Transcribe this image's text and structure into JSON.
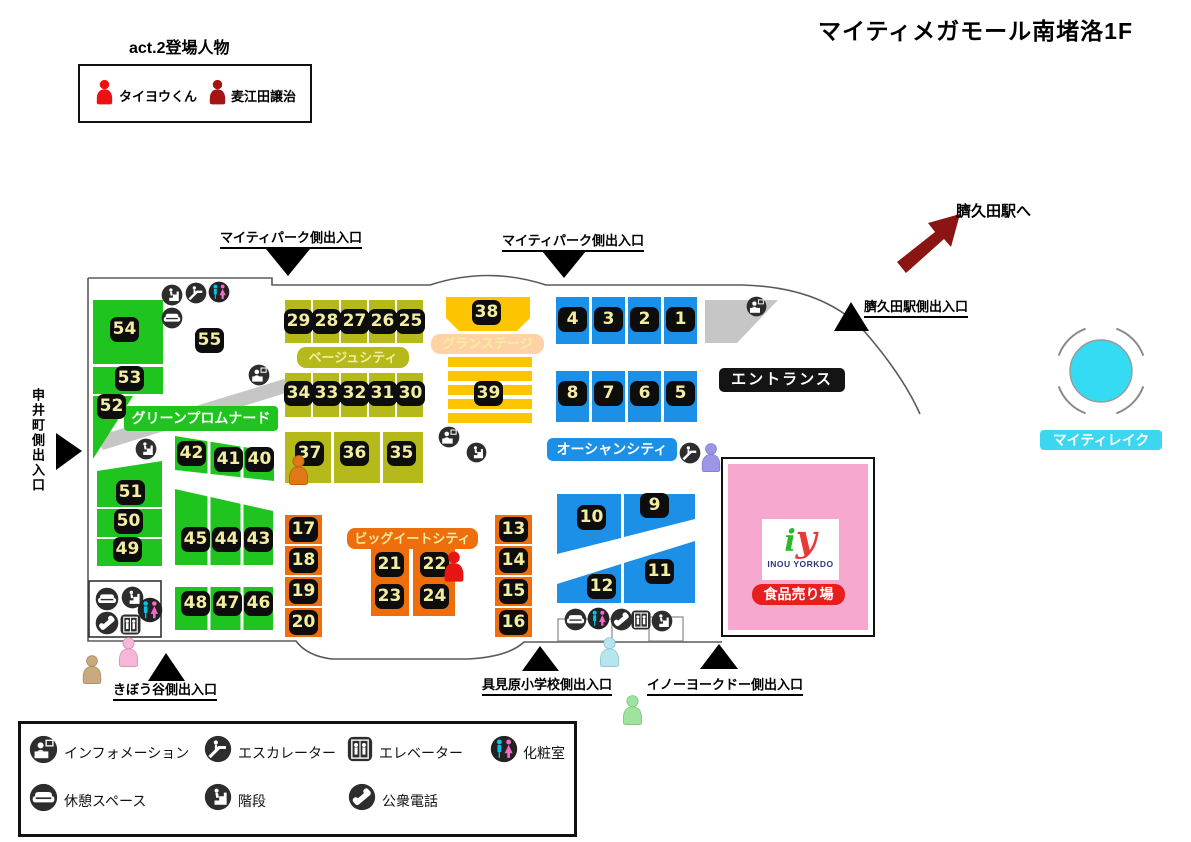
{
  "title": "マイティメガモール南堵洛1F",
  "cast": {
    "heading": "act.2登場人物",
    "members": [
      {
        "name": "タイヨウくん",
        "color": "#ee1111"
      },
      {
        "name": "麦江田譲治",
        "color": "#a51313"
      }
    ]
  },
  "areas": {
    "green_promenade": {
      "label": "グリーンプロムナード",
      "color": "#1fc41f"
    },
    "beige_city": {
      "label": "ベージュシティ",
      "color": "#b5b919"
    },
    "grand_stage": {
      "label": "グランステージ",
      "color": "#fdc500",
      "label_bg": "#ffd2a6"
    },
    "ocean_city": {
      "label": "オーシャンシティ",
      "color": "#1c8fe6"
    },
    "big_eat_city": {
      "label": "ビッグイートシティ",
      "color": "#ee6d0c"
    },
    "entrance": {
      "label": "エントランス"
    },
    "mighty_lake": {
      "label": "マイティレイク",
      "color": "#35dbf2"
    },
    "food_hall": {
      "label": "食品売り場",
      "store": "INOU YORKDO",
      "logo_i": "i",
      "logo_y": "y",
      "color": "#f6a8cf"
    }
  },
  "units": {
    "u1": "1",
    "u2": "2",
    "u3": "3",
    "u4": "4",
    "u5": "5",
    "u6": "6",
    "u7": "7",
    "u8": "8",
    "u9": "9",
    "u10": "10",
    "u11": "11",
    "u12": "12",
    "u13": "13",
    "u14": "14",
    "u15": "15",
    "u16": "16",
    "u17": "17",
    "u18": "18",
    "u19": "19",
    "u20": "20",
    "u21": "21",
    "u22": "22",
    "u23": "23",
    "u24": "24",
    "u25": "25",
    "u26": "26",
    "u27": "27",
    "u28": "28",
    "u29": "29",
    "u30": "30",
    "u31": "31",
    "u32": "32",
    "u33": "33",
    "u34": "34",
    "u35": "35",
    "u36": "36",
    "u37": "37",
    "u38": "38",
    "u39": "39",
    "u40": "40",
    "u41": "41",
    "u42": "42",
    "u43": "43",
    "u44": "44",
    "u45": "45",
    "u46": "46",
    "u47": "47",
    "u48": "48",
    "u49": "49",
    "u50": "50",
    "u51": "51",
    "u52": "52",
    "u53": "53",
    "u54": "54",
    "u55": "55"
  },
  "exits": {
    "mighty_park": "マイティパーク側出入口",
    "station_side": "臍久田駅側出入口",
    "station_direction": "臍久田駅へ",
    "saruimachi": "申井町側出入口",
    "kiboudani": "きぼう谷側出入口",
    "gumihara": "具見原小学校側出入口",
    "inou_yorkdo": "イノーヨークドー側出入口"
  },
  "legend": {
    "items": [
      {
        "icon": "information-icon",
        "label": "インフォメーション"
      },
      {
        "icon": "escalator-icon",
        "label": "エスカレーター"
      },
      {
        "icon": "elevator-icon",
        "label": "エレベーター"
      },
      {
        "icon": "restroom-icon",
        "label": "化粧室"
      },
      {
        "icon": "rest-space-icon",
        "label": "休憩スペース"
      },
      {
        "icon": "stairs-icon",
        "label": "階段"
      },
      {
        "icon": "public-phone-icon",
        "label": "公衆電話"
      }
    ]
  },
  "marker_colors": {
    "red": "#e81414",
    "orange": "#e07818",
    "lavender": "#9b97e6",
    "pink": "#f6b6d8",
    "tan": "#c9a97e",
    "light_blue": "#b5e6ef",
    "light_green": "#9fe39f"
  }
}
